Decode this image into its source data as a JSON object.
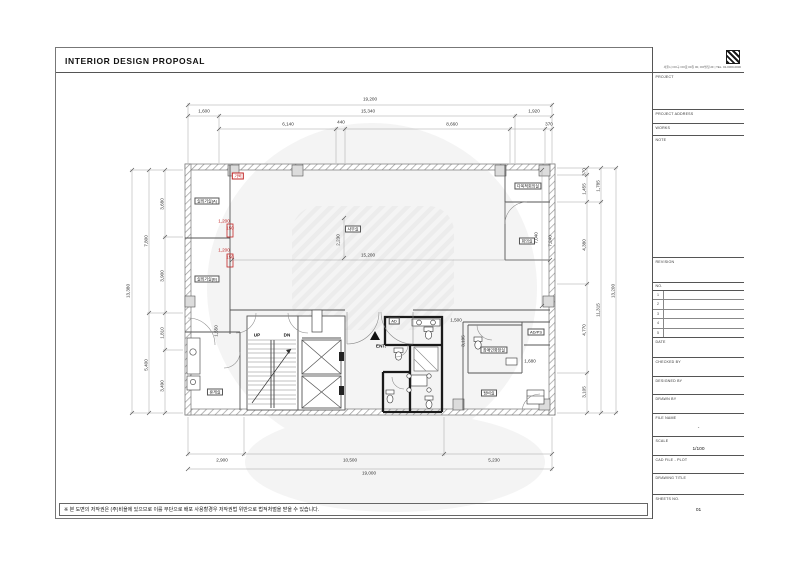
{
  "page": {
    "title": "INTERIOR DESIGN PROPOSAL",
    "copyright_note": "※ 본 도면의 저작권은 (주)비욜에 있으므로 이를 무단으로 배포 사용할경우 저작권법 위반으로 법적처벌을 받을 수 있습니다."
  },
  "logo": {
    "address": "서울시 OO구 OO로 00길 00, OO빌딩 2F | TEL. 02-0000-0000"
  },
  "titleblock": {
    "sections": [
      "PROJECT",
      "PROJECT ADDRESS",
      "WORKS",
      "NOTE",
      "REVISION",
      "NO.",
      "DATE",
      "CHECKED BY",
      "DESIGNED BY",
      "DRAWN BY",
      "FILE NAME",
      "SCALE",
      "CAD FILE - PLOT",
      "DRAWING TITLE",
      "SHEETS NO."
    ],
    "values": {
      "scale": "1/100",
      "sheet_no": "01",
      "file": "-"
    },
    "revision_rows": [
      "1",
      "2",
      "3",
      "4",
      "5"
    ]
  },
  "plan": {
    "rooms": [
      {
        "t": "실외기실(A)",
        "x": 207,
        "y": 201
      },
      {
        "t": "실외기실(B)",
        "x": 207,
        "y": 279
      },
      {
        "t": "사무실",
        "x": 353,
        "y": 229
      },
      {
        "t": "다목적회의실",
        "x": 528,
        "y": 186
      },
      {
        "t": "회의실",
        "x": 527,
        "y": 241
      },
      {
        "t": "AD/PS",
        "x": 536,
        "y": 332
      },
      {
        "t": "장애인화장실",
        "x": 494,
        "y": 350
      },
      {
        "t": "탕비실",
        "x": 489,
        "y": 393
      },
      {
        "t": "휴게실",
        "x": 215,
        "y": 392
      },
      {
        "t": "AD",
        "x": 394,
        "y": 321
      },
      {
        "t": "가벽",
        "x": 238,
        "y": 176,
        "red": 1
      }
    ],
    "texts": [
      {
        "t": "UP",
        "x": 257,
        "y": 336
      },
      {
        "t": "DN",
        "x": 287,
        "y": 336
      },
      {
        "t": "ENT.",
        "x": 381,
        "y": 347
      }
    ],
    "dims": [
      {
        "t": "19,200",
        "x": 370,
        "y": 100
      },
      {
        "t": "1,600",
        "x": 204,
        "y": 112
      },
      {
        "t": "15,340",
        "x": 368,
        "y": 112
      },
      {
        "t": "1,920",
        "x": 534,
        "y": 112
      },
      {
        "t": "6,140",
        "x": 288,
        "y": 125
      },
      {
        "t": "440",
        "x": 341,
        "y": 123
      },
      {
        "t": "8,660",
        "x": 452,
        "y": 125
      },
      {
        "t": "370",
        "x": 549,
        "y": 125
      },
      {
        "t": "2,900",
        "x": 222,
        "y": 461
      },
      {
        "t": "10,500",
        "x": 350,
        "y": 461
      },
      {
        "t": "5,230",
        "x": 494,
        "y": 461
      },
      {
        "t": "19,000",
        "x": 369,
        "y": 474
      },
      {
        "t": "13,380",
        "x": 129,
        "y": 291,
        "r": 1
      },
      {
        "t": "7,800",
        "x": 147,
        "y": 241,
        "r": 1
      },
      {
        "t": "5,400",
        "x": 147,
        "y": 365,
        "r": 1
      },
      {
        "t": "3,680",
        "x": 163,
        "y": 204,
        "r": 1
      },
      {
        "t": "3,900",
        "x": 163,
        "y": 276,
        "r": 1
      },
      {
        "t": "1,810",
        "x": 163,
        "y": 333,
        "r": 1
      },
      {
        "t": "3,490",
        "x": 163,
        "y": 386,
        "r": 1
      },
      {
        "t": "370",
        "x": 585,
        "y": 172,
        "r": 1
      },
      {
        "t": "1,455",
        "x": 585,
        "y": 189,
        "r": 1
      },
      {
        "t": "4,380",
        "x": 585,
        "y": 245,
        "r": 1
      },
      {
        "t": "4,770",
        "x": 585,
        "y": 330,
        "r": 1
      },
      {
        "t": "3,105",
        "x": 585,
        "y": 392,
        "r": 1
      },
      {
        "t": "1,785",
        "x": 599,
        "y": 186,
        "r": 1
      },
      {
        "t": "11,315",
        "x": 599,
        "y": 310,
        "r": 1
      },
      {
        "t": "13,200",
        "x": 614,
        "y": 291,
        "r": 1
      },
      {
        "t": "15,200",
        "x": 368,
        "y": 256
      },
      {
        "t": "2,230",
        "x": 339,
        "y": 240,
        "r": 1
      },
      {
        "t": "7,040",
        "x": 537,
        "y": 238,
        "r": 1
      },
      {
        "t": "7,240",
        "x": 551,
        "y": 241,
        "r": 1
      },
      {
        "t": "1,500",
        "x": 456,
        "y": 321
      },
      {
        "t": "3,195",
        "x": 464,
        "y": 341,
        "r": 1
      },
      {
        "t": "1,680",
        "x": 530,
        "y": 362
      },
      {
        "t": "1,550",
        "x": 217,
        "y": 331,
        "r": 1
      },
      {
        "t": "1,200",
        "x": 224,
        "y": 222,
        "red": 1
      },
      {
        "t": "150",
        "x": 230,
        "y": 229,
        "red": 1
      },
      {
        "t": "1,200",
        "x": 224,
        "y": 251,
        "red": 1
      },
      {
        "t": "150",
        "x": 230,
        "y": 258,
        "red": 1
      }
    ]
  }
}
